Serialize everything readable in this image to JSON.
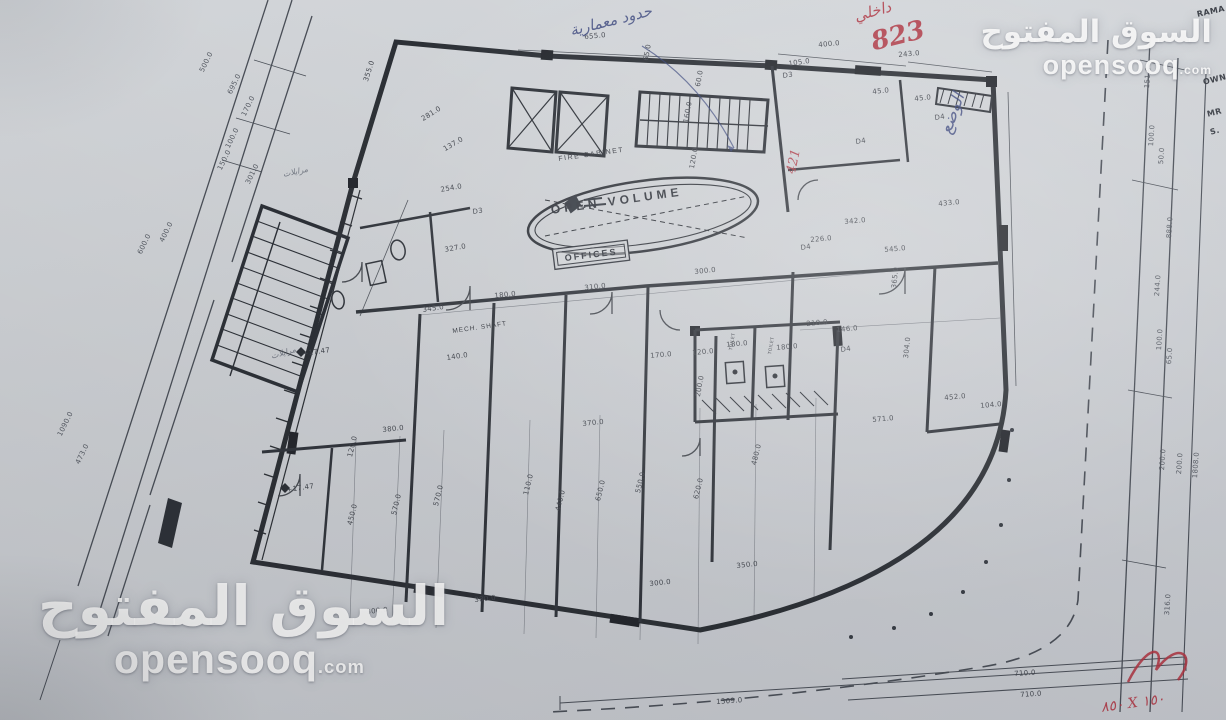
{
  "watermark": {
    "arabic": "السوق المفتوح",
    "latin": "opensooq",
    "tld": ".com"
  },
  "annotations": {
    "red_label_line1": "داخلي",
    "red_label_line2": "823",
    "blue_note": "حدود معمارية",
    "blue_status": "الوضع",
    "red_421": "421",
    "red_size_note": "٨٥٠ X ١٥٠",
    "pencil_note_1": "مرايلات",
    "pencil_note_2": "مرايلات"
  },
  "plan": {
    "room_labels": {
      "open_volume": "OPEN VOLUME",
      "offices": "OFFICES",
      "fire_cabinet": "FIRE CABINET",
      "mech_shaft": "MECH. SHAFT"
    },
    "dimensions": [
      {
        "t": "655.0",
        "x": 584,
        "y": 33,
        "r": -5
      },
      {
        "t": "355.0",
        "x": 362,
        "y": 80,
        "r": -72
      },
      {
        "t": "400.0",
        "x": 818,
        "y": 41,
        "r": -5
      },
      {
        "t": "243.0",
        "x": 898,
        "y": 51,
        "r": -5
      },
      {
        "t": "105.0",
        "x": 788,
        "y": 60,
        "r": -8
      },
      {
        "t": "45.0",
        "x": 872,
        "y": 88,
        "r": -6
      },
      {
        "t": "45.0",
        "x": 914,
        "y": 95,
        "r": -6
      },
      {
        "t": "65.0",
        "x": 642,
        "y": 60,
        "r": -80
      },
      {
        "t": "60.0",
        "x": 694,
        "y": 86,
        "r": -80
      },
      {
        "t": "160.0",
        "x": 682,
        "y": 122,
        "r": -80
      },
      {
        "t": "120.0",
        "x": 688,
        "y": 168,
        "r": -80
      },
      {
        "t": "281.0",
        "x": 420,
        "y": 116,
        "r": -32
      },
      {
        "t": "137.0",
        "x": 442,
        "y": 146,
        "r": -30
      },
      {
        "t": "254.0",
        "x": 440,
        "y": 186,
        "r": -10
      },
      {
        "t": "D3",
        "x": 472,
        "y": 208,
        "r": -8
      },
      {
        "t": "D3",
        "x": 782,
        "y": 72,
        "r": -8
      },
      {
        "t": "D4",
        "x": 855,
        "y": 138,
        "r": -8
      },
      {
        "t": "D4",
        "x": 934,
        "y": 114,
        "r": -8
      },
      {
        "t": "433.0",
        "x": 938,
        "y": 200,
        "r": -5
      },
      {
        "t": "342.0",
        "x": 844,
        "y": 218,
        "r": -5
      },
      {
        "t": "226.0",
        "x": 810,
        "y": 236,
        "r": -5
      },
      {
        "t": "545.0",
        "x": 884,
        "y": 246,
        "r": -5
      },
      {
        "t": "365.0",
        "x": 890,
        "y": 288,
        "r": -84
      },
      {
        "t": "327.0",
        "x": 444,
        "y": 246,
        "r": -10
      },
      {
        "t": "310.0",
        "x": 584,
        "y": 284,
        "r": -6
      },
      {
        "t": "300.0",
        "x": 694,
        "y": 268,
        "r": -6
      },
      {
        "t": "180.0",
        "x": 494,
        "y": 292,
        "r": -6
      },
      {
        "t": "345.0",
        "x": 422,
        "y": 306,
        "r": -8
      },
      {
        "t": "140.0",
        "x": 446,
        "y": 354,
        "r": -8
      },
      {
        "t": "210.0",
        "x": 806,
        "y": 320,
        "r": -5
      },
      {
        "t": "146.0",
        "x": 836,
        "y": 326,
        "r": -5
      },
      {
        "t": "180.0",
        "x": 726,
        "y": 341,
        "r": -5
      },
      {
        "t": "180.0",
        "x": 776,
        "y": 344,
        "r": -5
      },
      {
        "t": "120.0",
        "x": 692,
        "y": 349,
        "r": -5
      },
      {
        "t": "170.0",
        "x": 650,
        "y": 352,
        "r": -5
      },
      {
        "t": "200.0",
        "x": 694,
        "y": 396,
        "r": -80
      },
      {
        "t": "D4",
        "x": 800,
        "y": 244,
        "r": -8
      },
      {
        "t": "D4",
        "x": 840,
        "y": 346,
        "r": -8
      },
      {
        "t": "+17.47",
        "x": 302,
        "y": 350,
        "r": -8
      },
      {
        "t": "+17.47",
        "x": 286,
        "y": 486,
        "r": -8
      },
      {
        "t": "571.0",
        "x": 872,
        "y": 416,
        "r": -5
      },
      {
        "t": "452.0",
        "x": 944,
        "y": 394,
        "r": -5
      },
      {
        "t": "104.0",
        "x": 980,
        "y": 402,
        "r": -5
      },
      {
        "t": "304.0",
        "x": 902,
        "y": 358,
        "r": -84
      },
      {
        "t": "380.0",
        "x": 382,
        "y": 426,
        "r": -6
      },
      {
        "t": "120.0",
        "x": 346,
        "y": 456,
        "r": -76
      },
      {
        "t": "450.0",
        "x": 346,
        "y": 524,
        "r": -76
      },
      {
        "t": "570.0",
        "x": 390,
        "y": 514,
        "r": -76
      },
      {
        "t": "570.0",
        "x": 432,
        "y": 505,
        "r": -76
      },
      {
        "t": "370.0",
        "x": 582,
        "y": 420,
        "r": -6
      },
      {
        "t": "110.0",
        "x": 522,
        "y": 494,
        "r": -76
      },
      {
        "t": "440.0",
        "x": 554,
        "y": 510,
        "r": -76
      },
      {
        "t": "650.0",
        "x": 594,
        "y": 500,
        "r": -76
      },
      {
        "t": "550.0",
        "x": 634,
        "y": 492,
        "r": -76
      },
      {
        "t": "620.0",
        "x": 692,
        "y": 498,
        "r": -76
      },
      {
        "t": "480.0",
        "x": 750,
        "y": 464,
        "r": -76
      },
      {
        "t": "300.0",
        "x": 649,
        "y": 580,
        "r": -6
      },
      {
        "t": "380.0",
        "x": 474,
        "y": 596,
        "r": -6
      },
      {
        "t": "300.0",
        "x": 366,
        "y": 608,
        "r": -6
      },
      {
        "t": "350.0",
        "x": 736,
        "y": 562,
        "r": -6
      },
      {
        "t": "1309.0",
        "x": 716,
        "y": 698,
        "r": -4
      },
      {
        "t": "710.0",
        "x": 1014,
        "y": 670,
        "r": -4
      },
      {
        "t": "710.0",
        "x": 1020,
        "y": 691,
        "r": -4
      },
      {
        "t": "TOILET",
        "x": 729,
        "y": 350,
        "r": -80,
        "fs": 4.5
      },
      {
        "t": "TOILET",
        "x": 768,
        "y": 354,
        "r": -80,
        "fs": 4.5
      }
    ],
    "street_dimensions": [
      {
        "t": "500.0",
        "x": 198,
        "y": 70,
        "r": -64
      },
      {
        "t": "695.0",
        "x": 226,
        "y": 92,
        "r": -64
      },
      {
        "t": "170.0",
        "x": 240,
        "y": 114,
        "r": -64
      },
      {
        "t": "100.0",
        "x": 224,
        "y": 146,
        "r": -64
      },
      {
        "t": "150.0",
        "x": 216,
        "y": 168,
        "r": -64
      },
      {
        "t": "301.0",
        "x": 244,
        "y": 182,
        "r": -64
      },
      {
        "t": "600.0",
        "x": 136,
        "y": 252,
        "r": -64
      },
      {
        "t": "400.0",
        "x": 158,
        "y": 240,
        "r": -64
      },
      {
        "t": "1090.0",
        "x": 56,
        "y": 434,
        "r": -64
      },
      {
        "t": "473.0",
        "x": 74,
        "y": 462,
        "r": -64
      },
      {
        "t": "151.0",
        "x": 1143,
        "y": 88,
        "r": -86
      },
      {
        "t": "100.0",
        "x": 1147,
        "y": 146,
        "r": -86
      },
      {
        "t": "50.0",
        "x": 1157,
        "y": 164,
        "r": -86
      },
      {
        "t": "888.0",
        "x": 1165,
        "y": 238,
        "r": -86
      },
      {
        "t": "244.0",
        "x": 1153,
        "y": 296,
        "r": -86
      },
      {
        "t": "100.0",
        "x": 1155,
        "y": 350,
        "r": -86
      },
      {
        "t": "65.0",
        "x": 1165,
        "y": 364,
        "r": -86
      },
      {
        "t": "200.0",
        "x": 1158,
        "y": 470,
        "r": -86
      },
      {
        "t": "200.0",
        "x": 1175,
        "y": 474,
        "r": -86
      },
      {
        "t": "1808.0",
        "x": 1191,
        "y": 478,
        "r": -86
      },
      {
        "t": "316.0",
        "x": 1163,
        "y": 615,
        "r": -86
      }
    ],
    "edge_texts": [
      {
        "t": "RAMA",
        "x": 1196,
        "y": 10,
        "r": -12
      },
      {
        "t": "OWN",
        "x": 1202,
        "y": 78,
        "r": -14
      },
      {
        "t": "MR",
        "x": 1206,
        "y": 110,
        "r": -14
      },
      {
        "t": "S.",
        "x": 1209,
        "y": 128,
        "r": -14
      }
    ]
  }
}
